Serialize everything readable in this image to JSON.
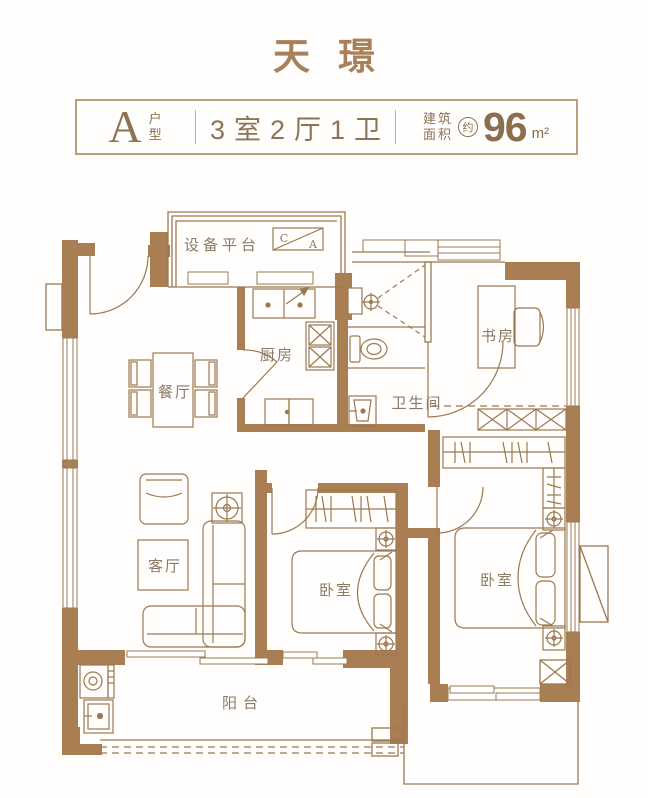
{
  "title": "天璟",
  "header": {
    "type_letter": "A",
    "type_label_line1": "户",
    "type_label_line2": "型",
    "layout": "3室2厅1卫",
    "area_prefix_line1": "建筑",
    "area_prefix_line2": "面积",
    "area_approx": "约",
    "area_value": "96",
    "area_unit": "m²"
  },
  "rooms": {
    "equipment_platform": "设备平台",
    "kitchen": "厨房",
    "dining": "餐厅",
    "bathroom": "卫生间",
    "study": "书房",
    "living": "客厅",
    "bedroom_middle": "卧室",
    "bedroom_right": "卧室",
    "balcony": "阳台"
  },
  "markers": {
    "ac_box_top": "C",
    "ac_box_bottom": "A"
  },
  "colors": {
    "wall": "#a87e52",
    "line": "#9b7951",
    "label_text": "#8b7a64",
    "accent_text": "#8d7355",
    "title_text": "#a8815a",
    "background": "#fffefc"
  }
}
